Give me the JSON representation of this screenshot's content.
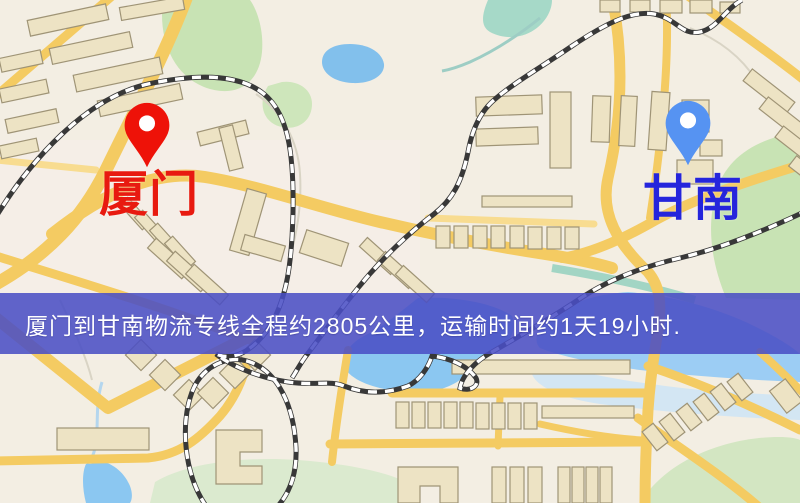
{
  "banner": {
    "text": "厦门到甘南物流专线全程约2805公里，运输时间约1天19小时.",
    "background_color": "#4952c4",
    "text_color": "#ffffff"
  },
  "markers": {
    "origin": {
      "label": "厦门",
      "pin_color": "#ee1208",
      "pin_hole_color": "#ffffff",
      "label_color": "#e81a10"
    },
    "destination": {
      "label": "甘南",
      "pin_color": "#5693f2",
      "pin_hole_color": "#ffffff",
      "label_color": "#2525dc"
    }
  },
  "map_palette": {
    "background": "#f3eee4",
    "road_major": "#f2cb68",
    "road_minor": "#f6dc94",
    "building_fill": "#ece3c6",
    "building_stroke": "#9e9478",
    "railway_dark": "#383838",
    "railway_light": "#ffffff",
    "water": "#8ec6ee",
    "park_green": "#c9e2b6",
    "park_pale": "#dcead0"
  }
}
